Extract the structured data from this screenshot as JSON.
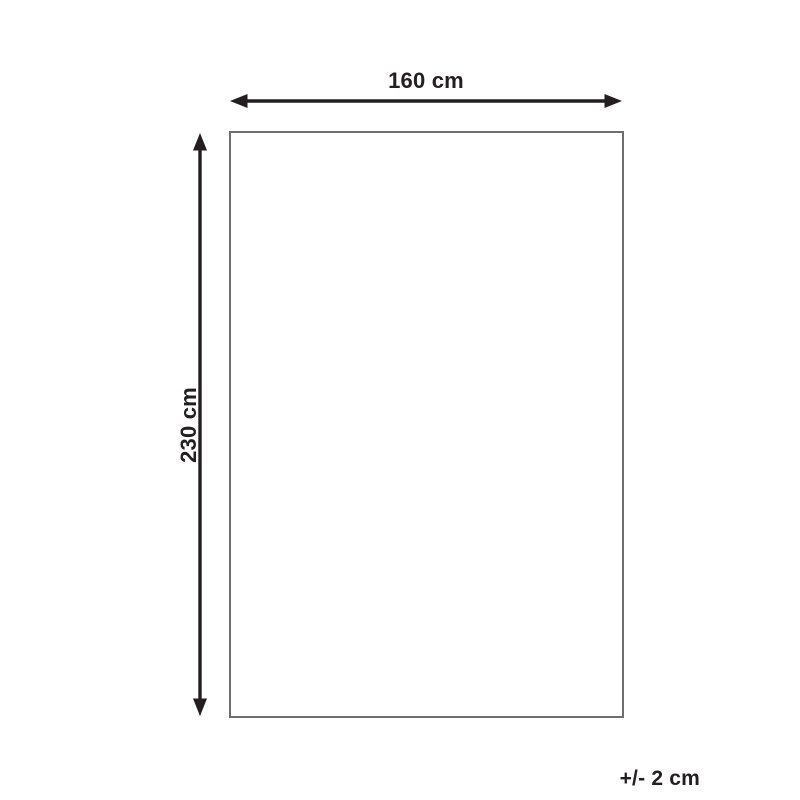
{
  "diagram": {
    "width_label": "160 cm",
    "height_label": "230 cm",
    "tolerance_label": "+/- 2 cm",
    "colors": {
      "background": "#ffffff",
      "arrow": "#231f20",
      "text": "#231f20",
      "outline": "#6e6e6e"
    }
  }
}
